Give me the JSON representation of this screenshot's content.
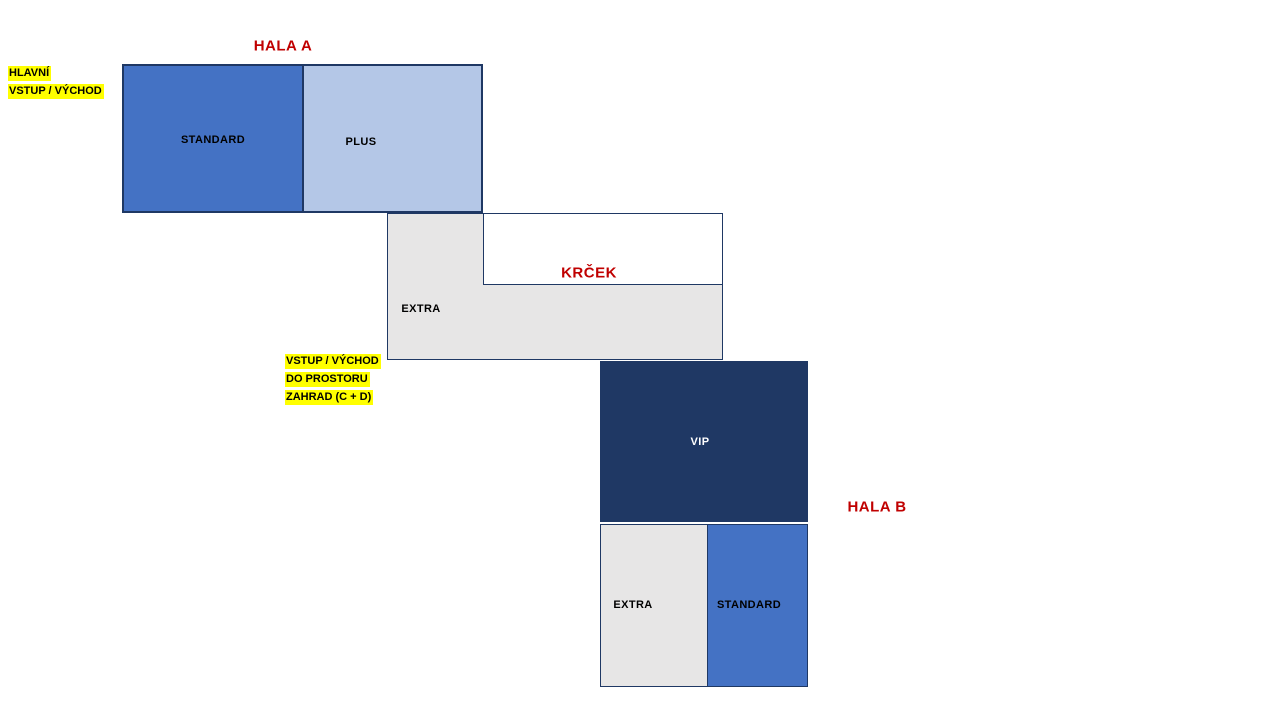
{
  "diagram": {
    "hala_a": {
      "title": "HALA  A",
      "zones": {
        "standard": "STANDARD",
        "plus": "PLUS"
      }
    },
    "krcek": {
      "title": "KRČEK",
      "extra_label": "EXTRA"
    },
    "hala_b": {
      "title": "HALA  B",
      "zones": {
        "vip": "VIP",
        "extra": "EXTRA",
        "standard": "STANDARD"
      }
    },
    "labels": {
      "main_entrance": {
        "lines": [
          "HLAVNÍ",
          "VSTUP / VÝCHOD"
        ]
      },
      "garden_entrance": {
        "lines": [
          "VSTUP / VÝCHOD",
          "DO PROSTORU",
          "ZAHRAD (C + D)"
        ]
      }
    },
    "colors": {
      "standard_blue": "#4472C4",
      "plus_light_blue": "#B4C7E7",
      "vip_navy": "#1F3864",
      "extra_gray": "#E7E6E6",
      "border_navy": "#1F3864",
      "title_red": "#C00000",
      "highlight_yellow": "#FFFF00"
    }
  }
}
